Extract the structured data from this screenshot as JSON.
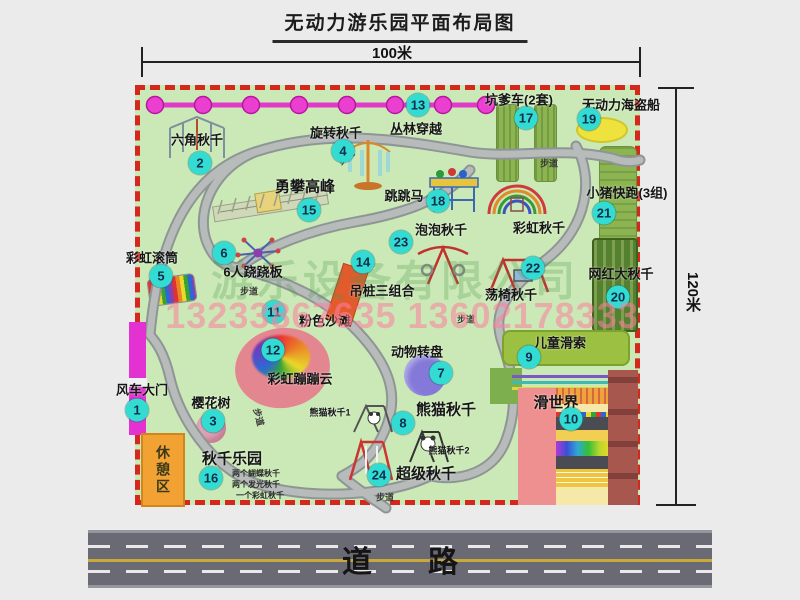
{
  "title": "无动力游乐园平面布局图",
  "dimensions": {
    "width": "100米",
    "height": "120米"
  },
  "road": {
    "label": "道路"
  },
  "trail_label": "步道",
  "rest_area": "休憩区",
  "watermarks": {
    "company": "游乐设备有限公司",
    "phone": "13233867635 13602178333"
  },
  "items": [
    {
      "num": "1",
      "label": "风车大门"
    },
    {
      "num": "2",
      "label": "六角秋千"
    },
    {
      "num": "3",
      "label": "樱花树"
    },
    {
      "num": "4",
      "label": "旋转秋千"
    },
    {
      "num": "5",
      "label": "彩虹滚筒"
    },
    {
      "num": "6",
      "label": "6人跷跷板"
    },
    {
      "num": "7",
      "label": "动物转盘"
    },
    {
      "num": "8",
      "label": "熊猫秋千",
      "sub1": "熊猫秋千1",
      "sub2": "熊猫秋千2"
    },
    {
      "num": "9",
      "label": "儿童滑索"
    },
    {
      "num": "10",
      "label": "滑世界"
    },
    {
      "num": "11",
      "label": "粉色沙滩"
    },
    {
      "num": "12",
      "label": "彩虹蹦蹦云"
    },
    {
      "num": "13",
      "label": "丛林穿越"
    },
    {
      "num": "14",
      "label": "吊桩三组合"
    },
    {
      "num": "15",
      "label": "勇攀高峰"
    },
    {
      "num": "16",
      "label": "秋千乐园",
      "notes": [
        "两个蝴蝶秋千",
        "两个发光秋千",
        "一个彩虹秋千"
      ]
    },
    {
      "num": "17",
      "label": "坑爹车(2套)"
    },
    {
      "num": "18",
      "label": "跳跳马"
    },
    {
      "num": "19",
      "label": "无动力海盗船"
    },
    {
      "num": "20",
      "label": "网红大秋千"
    },
    {
      "num": "21",
      "label": "小猪快跑(3组)"
    },
    {
      "num": "22",
      "label": "荡椅秋千"
    },
    {
      "num": "23",
      "label": "泡泡秋千"
    },
    {
      "num": "24",
      "label": "超级秋千"
    }
  ],
  "unnumbered": {
    "rainbow_swing": "彩虹秋千"
  }
}
